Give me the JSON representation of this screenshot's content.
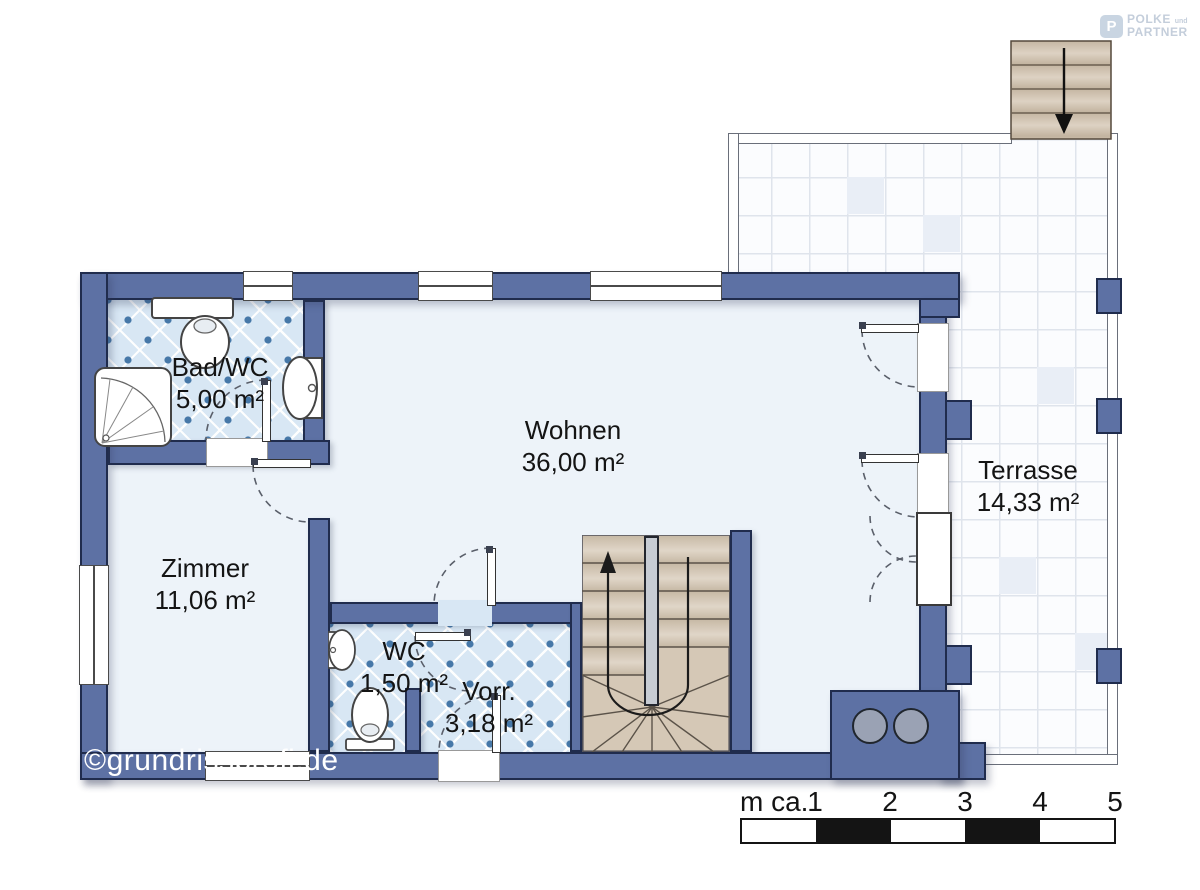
{
  "logo": {
    "icon_letter": "P",
    "line1": "POLKE",
    "line1_suffix": "und",
    "line2": "PARTNER"
  },
  "watermark": "©grundrissprofi.de",
  "rooms": [
    {
      "name": "Bad/WC",
      "area": "5,00 m²"
    },
    {
      "name": "Zimmer",
      "area": "11,06 m²"
    },
    {
      "name": "Wohnen",
      "area": "36,00 m²"
    },
    {
      "name": "WC",
      "area": "1,50 m²"
    },
    {
      "name": "Vorr.",
      "area": "3,18 m²"
    },
    {
      "name": "Terrasse",
      "area": "14,33 m²"
    }
  ],
  "scale_bar": {
    "unit_label": "m ca.",
    "ticks": [
      "1",
      "2",
      "3",
      "4",
      "5"
    ]
  },
  "colors": {
    "wall": "#5d71a4",
    "wall_outline": "#202c4d",
    "tile_blue": "#d8e7f4",
    "tile_dot": "#4678a8",
    "stair_tread": "#d5c8b6",
    "floor": "#edf3f9",
    "terrace_grid_line": "#dfe4ec"
  }
}
